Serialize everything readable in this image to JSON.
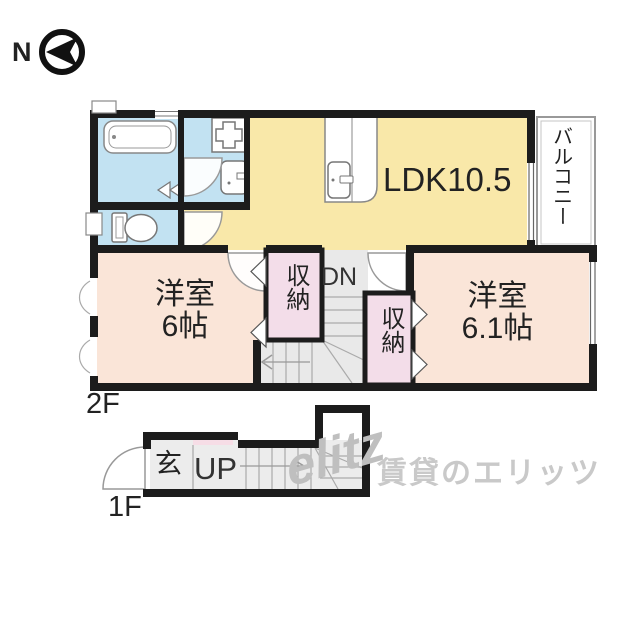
{
  "compass": {
    "north_label": "N"
  },
  "floor2": {
    "floor_label": "2F",
    "ldk_label": "LDK10.5",
    "balcony_label": "バルコニー",
    "bedroom_left_name": "洋室",
    "bedroom_left_size": "6帖",
    "bedroom_right_name": "洋室",
    "bedroom_right_size": "6.1帖",
    "closet_left_label": "収納",
    "closet_right_label": "収納",
    "stairs_down_label": "DN"
  },
  "floor1": {
    "floor_label": "1F",
    "entrance_label": "玄",
    "stairs_up_label": "UP"
  },
  "watermark": {
    "logo": "elitz",
    "text": "賃貸のエリッツ"
  },
  "colors": {
    "ldk": "#f9e8a9",
    "bedroom": "#fae5d8",
    "closet": "#f3dde9",
    "pink_strip": "#f6dde6",
    "water_area": "#c2e2f2",
    "stairs": "#e9e9e9",
    "wall": "#1c1c1c",
    "watermark": "#c9c9c9"
  }
}
